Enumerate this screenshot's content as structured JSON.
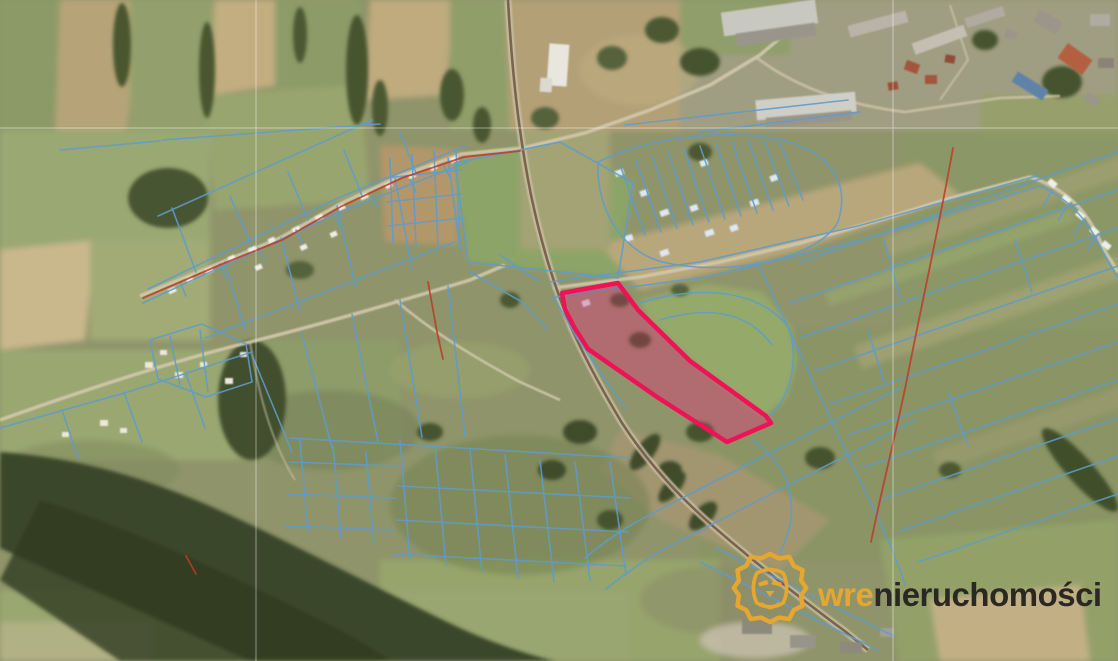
{
  "brand": {
    "logo_prefix": "wre",
    "logo_suffix": "nieruchomości",
    "logo_prefix_color": "#E5A72F",
    "logo_suffix_color": "#2B2824",
    "logo_icon": "lion",
    "logo_icon_color": "#E5A72F"
  },
  "map": {
    "kind": "aerial-orthophoto-with-cadastral-overlay",
    "highlight_outline_color": "#ED1356",
    "highlight_fill_color": "rgba(214,40,110,0.30)",
    "cadastral_line_color": "#5E9CCC",
    "district_boundary_color": "#BE3A28",
    "section_line_color": "rgba(255,255,255,0.5)",
    "visible_features": [
      "highlighted-parcel",
      "cadastral-parcel-lines",
      "railway-line",
      "village-roads",
      "town-buildings",
      "fields",
      "forest"
    ]
  }
}
